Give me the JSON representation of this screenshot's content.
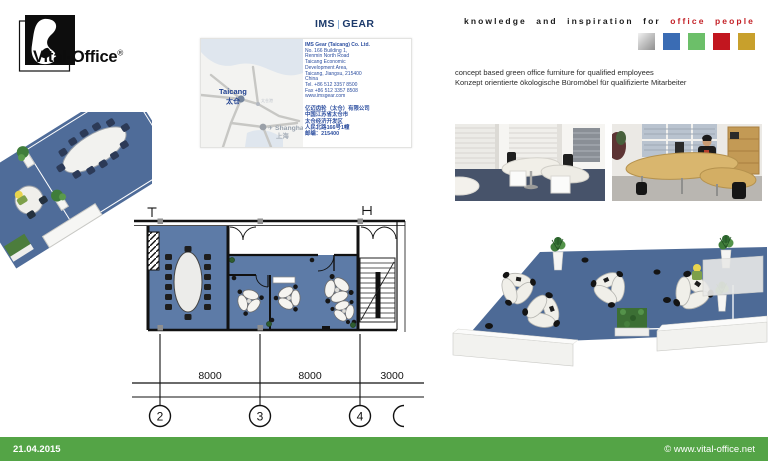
{
  "brand": {
    "logo_text": "Vital-Office",
    "logo_reg": "®",
    "ims": "IMS",
    "gear": "GEAR",
    "tagline_prefix": "knowledge and inspiration for",
    "tagline_accent": "office people",
    "accent_red": "#c32026",
    "palette_squares": [
      "#c9c9c9",
      "#3a6cb4",
      "#6cbf69",
      "#c2161f",
      "#c8a02c"
    ]
  },
  "card": {
    "map": {
      "taicang": "Taicang",
      "taicang_cn": "太仓",
      "port_label": "太仓港",
      "plane_icon": "✈",
      "shanghai": "Shanghai",
      "shanghai_cn": "上海"
    },
    "lines_en": [
      "IMS Gear (Taicang) Co. Ltd.",
      "No. 166 Building 1,",
      "Renmin North Road",
      "Taicang Economic",
      "Development Area,",
      "Taicang, Jiangsu, 215400",
      "China",
      "Tel. +86 512 3357 8500",
      "Fax +86 512 3357 8508",
      "www.imsgear.com"
    ],
    "lines_cn": [
      "亿迈齿轮（太仓）有限公司",
      "中国江苏省太仓市",
      "太仓经济开发区",
      "人民北路166号1幢",
      "邮编：215400"
    ]
  },
  "headline": {
    "en": "concept based green office furniture for qualified employees",
    "de": "Konzept orientierte ökologische Büromöbel für qualifizierte Mitarbeiter"
  },
  "floorplan": {
    "dims": [
      "8000",
      "8000",
      "3000"
    ],
    "grid": [
      "2",
      "3",
      "4"
    ],
    "area_label": "720.0m²",
    "floor_color": "#5d7ba7"
  },
  "footer": {
    "date": "21.04.2015",
    "copyright": "© www.vital-office.net",
    "bar_color": "#54a446"
  }
}
